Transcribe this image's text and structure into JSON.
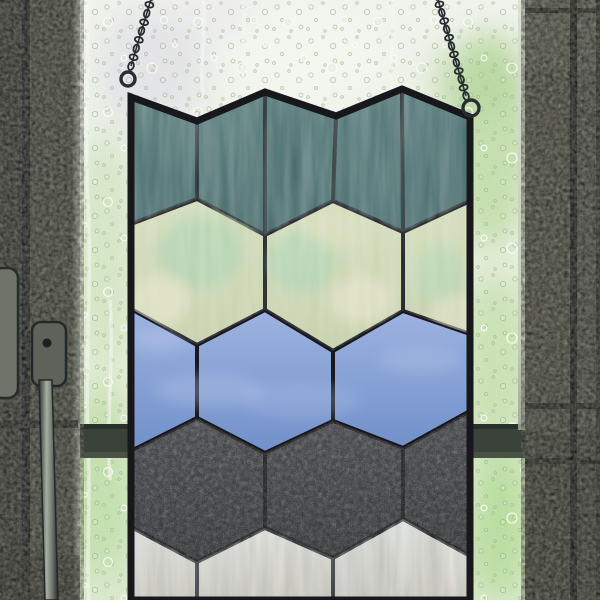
{
  "scene": {
    "subject": "stained-glass-window-panel-photo",
    "setting": "panel hanging by two chains inside a window with rain droplets and green foliage outside",
    "text_content": "none"
  },
  "palette": {
    "lead_line": "#17171c",
    "glass_top": "#eff1eb",
    "glass_bottom": "#d4e6c6",
    "foliage_green": "#abd18c",
    "frame_left_base": "#4d5248",
    "frame_right_base": "#5a5e53",
    "sash_bar": "#3a423a",
    "chain_metal": "#262b2f",
    "highlight_strip": "#ccd2c2"
  },
  "panel": {
    "lead": "#17171c",
    "outline": [
      [
        131,
        97
      ],
      [
        197,
        121
      ],
      [
        265,
        92
      ],
      [
        336,
        116
      ],
      [
        402,
        89
      ],
      [
        470,
        117
      ],
      [
        470,
        600
      ],
      [
        131,
        600
      ]
    ],
    "rows": [
      {
        "name": "teal",
        "label": "slate-teal streaked glass",
        "colors": [
          "#5b8282",
          "#446b6e"
        ]
      },
      {
        "name": "celadon",
        "label": "pale celadon mottled glass",
        "colors": [
          "#d4dcba",
          "#c4cfa8"
        ]
      },
      {
        "name": "blue",
        "label": "cornflower blue glass",
        "colors": [
          "#9db3e0",
          "#7190ca"
        ]
      },
      {
        "name": "dark",
        "label": "charcoal rippled clear glass",
        "colors": [
          "#515459",
          "#35383d"
        ]
      },
      {
        "name": "white",
        "label": "pearl white wispy glass",
        "colors": [
          "#e7e4de",
          "#cbc5bb"
        ]
      }
    ],
    "pieces": [
      {
        "row": "teal",
        "points": [
          [
            131,
            97
          ],
          [
            197,
            121
          ],
          [
            197,
            199
          ],
          [
            131,
            224
          ]
        ]
      },
      {
        "row": "teal",
        "points": [
          [
            197,
            121
          ],
          [
            265,
            92
          ],
          [
            265,
            235
          ],
          [
            197,
            199
          ]
        ]
      },
      {
        "row": "teal",
        "points": [
          [
            265,
            92
          ],
          [
            336,
            116
          ],
          [
            333,
            201
          ],
          [
            265,
            235
          ]
        ]
      },
      {
        "row": "teal",
        "points": [
          [
            336,
            116
          ],
          [
            402,
            89
          ],
          [
            403,
            232
          ],
          [
            333,
            201
          ]
        ]
      },
      {
        "row": "teal",
        "points": [
          [
            402,
            89
          ],
          [
            470,
            117
          ],
          [
            470,
            201
          ],
          [
            403,
            232
          ]
        ]
      },
      {
        "row": "celadon",
        "points": [
          [
            197,
            199
          ],
          [
            265,
            235
          ],
          [
            265,
            310
          ],
          [
            197,
            345
          ],
          [
            131,
            309
          ],
          [
            131,
            224
          ]
        ]
      },
      {
        "row": "celadon",
        "points": [
          [
            333,
            201
          ],
          [
            403,
            232
          ],
          [
            403,
            311
          ],
          [
            333,
            351
          ],
          [
            265,
            310
          ],
          [
            265,
            235
          ]
        ]
      },
      {
        "row": "celadon",
        "points": [
          [
            470,
            201
          ],
          [
            470,
            334
          ],
          [
            403,
            311
          ],
          [
            403,
            232
          ]
        ]
      },
      {
        "row": "blue",
        "points": [
          [
            131,
            309
          ],
          [
            197,
            345
          ],
          [
            197,
            418
          ],
          [
            131,
            451
          ]
        ]
      },
      {
        "row": "blue",
        "points": [
          [
            265,
            310
          ],
          [
            333,
            351
          ],
          [
            333,
            421
          ],
          [
            265,
            453
          ],
          [
            197,
            418
          ],
          [
            197,
            345
          ]
        ]
      },
      {
        "row": "blue",
        "points": [
          [
            403,
            311
          ],
          [
            470,
            334
          ],
          [
            470,
            411
          ],
          [
            403,
            448
          ],
          [
            333,
            421
          ],
          [
            333,
            351
          ]
        ]
      },
      {
        "row": "dark",
        "points": [
          [
            197,
            418
          ],
          [
            265,
            453
          ],
          [
            265,
            528
          ],
          [
            197,
            562
          ],
          [
            131,
            527
          ],
          [
            131,
            451
          ]
        ]
      },
      {
        "row": "dark",
        "points": [
          [
            333,
            421
          ],
          [
            403,
            448
          ],
          [
            403,
            519
          ],
          [
            333,
            558
          ],
          [
            265,
            528
          ],
          [
            265,
            453
          ]
        ]
      },
      {
        "row": "dark",
        "points": [
          [
            470,
            411
          ],
          [
            470,
            556
          ],
          [
            403,
            519
          ],
          [
            403,
            448
          ]
        ]
      },
      {
        "row": "white",
        "points": [
          [
            131,
            527
          ],
          [
            197,
            562
          ],
          [
            197,
            600
          ],
          [
            131,
            600
          ]
        ]
      },
      {
        "row": "white",
        "points": [
          [
            265,
            528
          ],
          [
            333,
            558
          ],
          [
            333,
            600
          ],
          [
            197,
            600
          ],
          [
            197,
            562
          ]
        ]
      },
      {
        "row": "white",
        "points": [
          [
            403,
            519
          ],
          [
            470,
            556
          ],
          [
            470,
            600
          ],
          [
            333,
            600
          ],
          [
            333,
            558
          ]
        ]
      }
    ]
  },
  "chains": [
    {
      "side": "left",
      "x1": 152,
      "y1": -4,
      "x2": 131,
      "y2": 66,
      "links": 9
    },
    {
      "side": "right",
      "x1": 437,
      "y1": -4,
      "x2": 466,
      "y2": 96,
      "links": 13
    }
  ],
  "rings": [
    {
      "side": "left",
      "cx": 128,
      "cy": 79,
      "r": 7
    },
    {
      "side": "right",
      "cx": 471,
      "cy": 108,
      "r": 8
    }
  ],
  "window": {
    "left_frame_width": 80,
    "right_frame_start": 525,
    "sash_bar_y": 424,
    "sash_bar_height": 34,
    "has_door_handle": true
  }
}
